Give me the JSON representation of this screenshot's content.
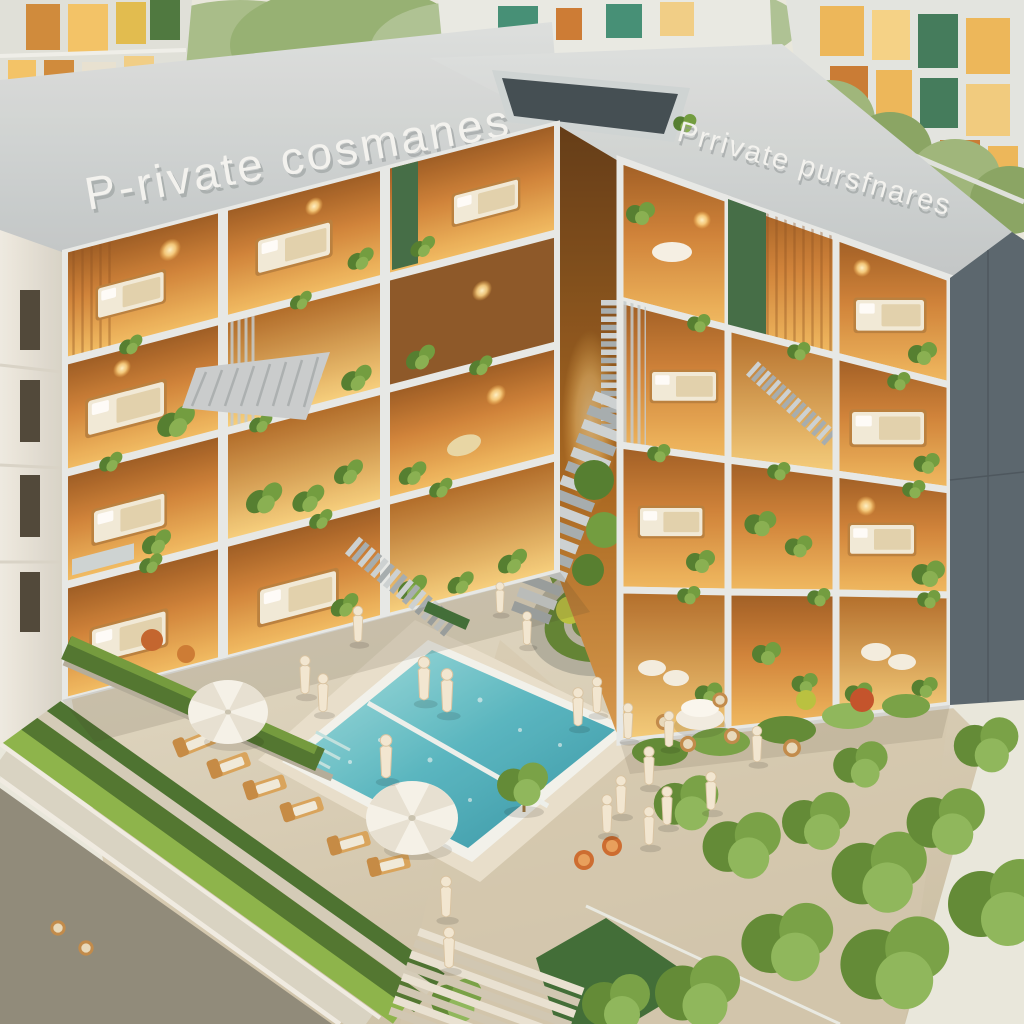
{
  "scene": {
    "type": "isometric-architectural-rendering",
    "signs": {
      "left_roof": "P-rivate cosmanes",
      "right_roof": "Prrivate pursfnares"
    },
    "palette": {
      "roof_concrete": "#ccd3d6",
      "facade_frame": "#e7ebec",
      "interior_glow": "#f2b95e",
      "wood_orange": "#c27430",
      "greenery": "#6f9c46",
      "hedge_dark": "#4c742f",
      "hedge_bright": "#8ab54a",
      "pool_water": "#57bcc8",
      "paving": "#d8cfbb",
      "road_asphalt": "#8d897c",
      "side_wall": "#55646f",
      "sign_white": "#f4f6f6"
    }
  }
}
